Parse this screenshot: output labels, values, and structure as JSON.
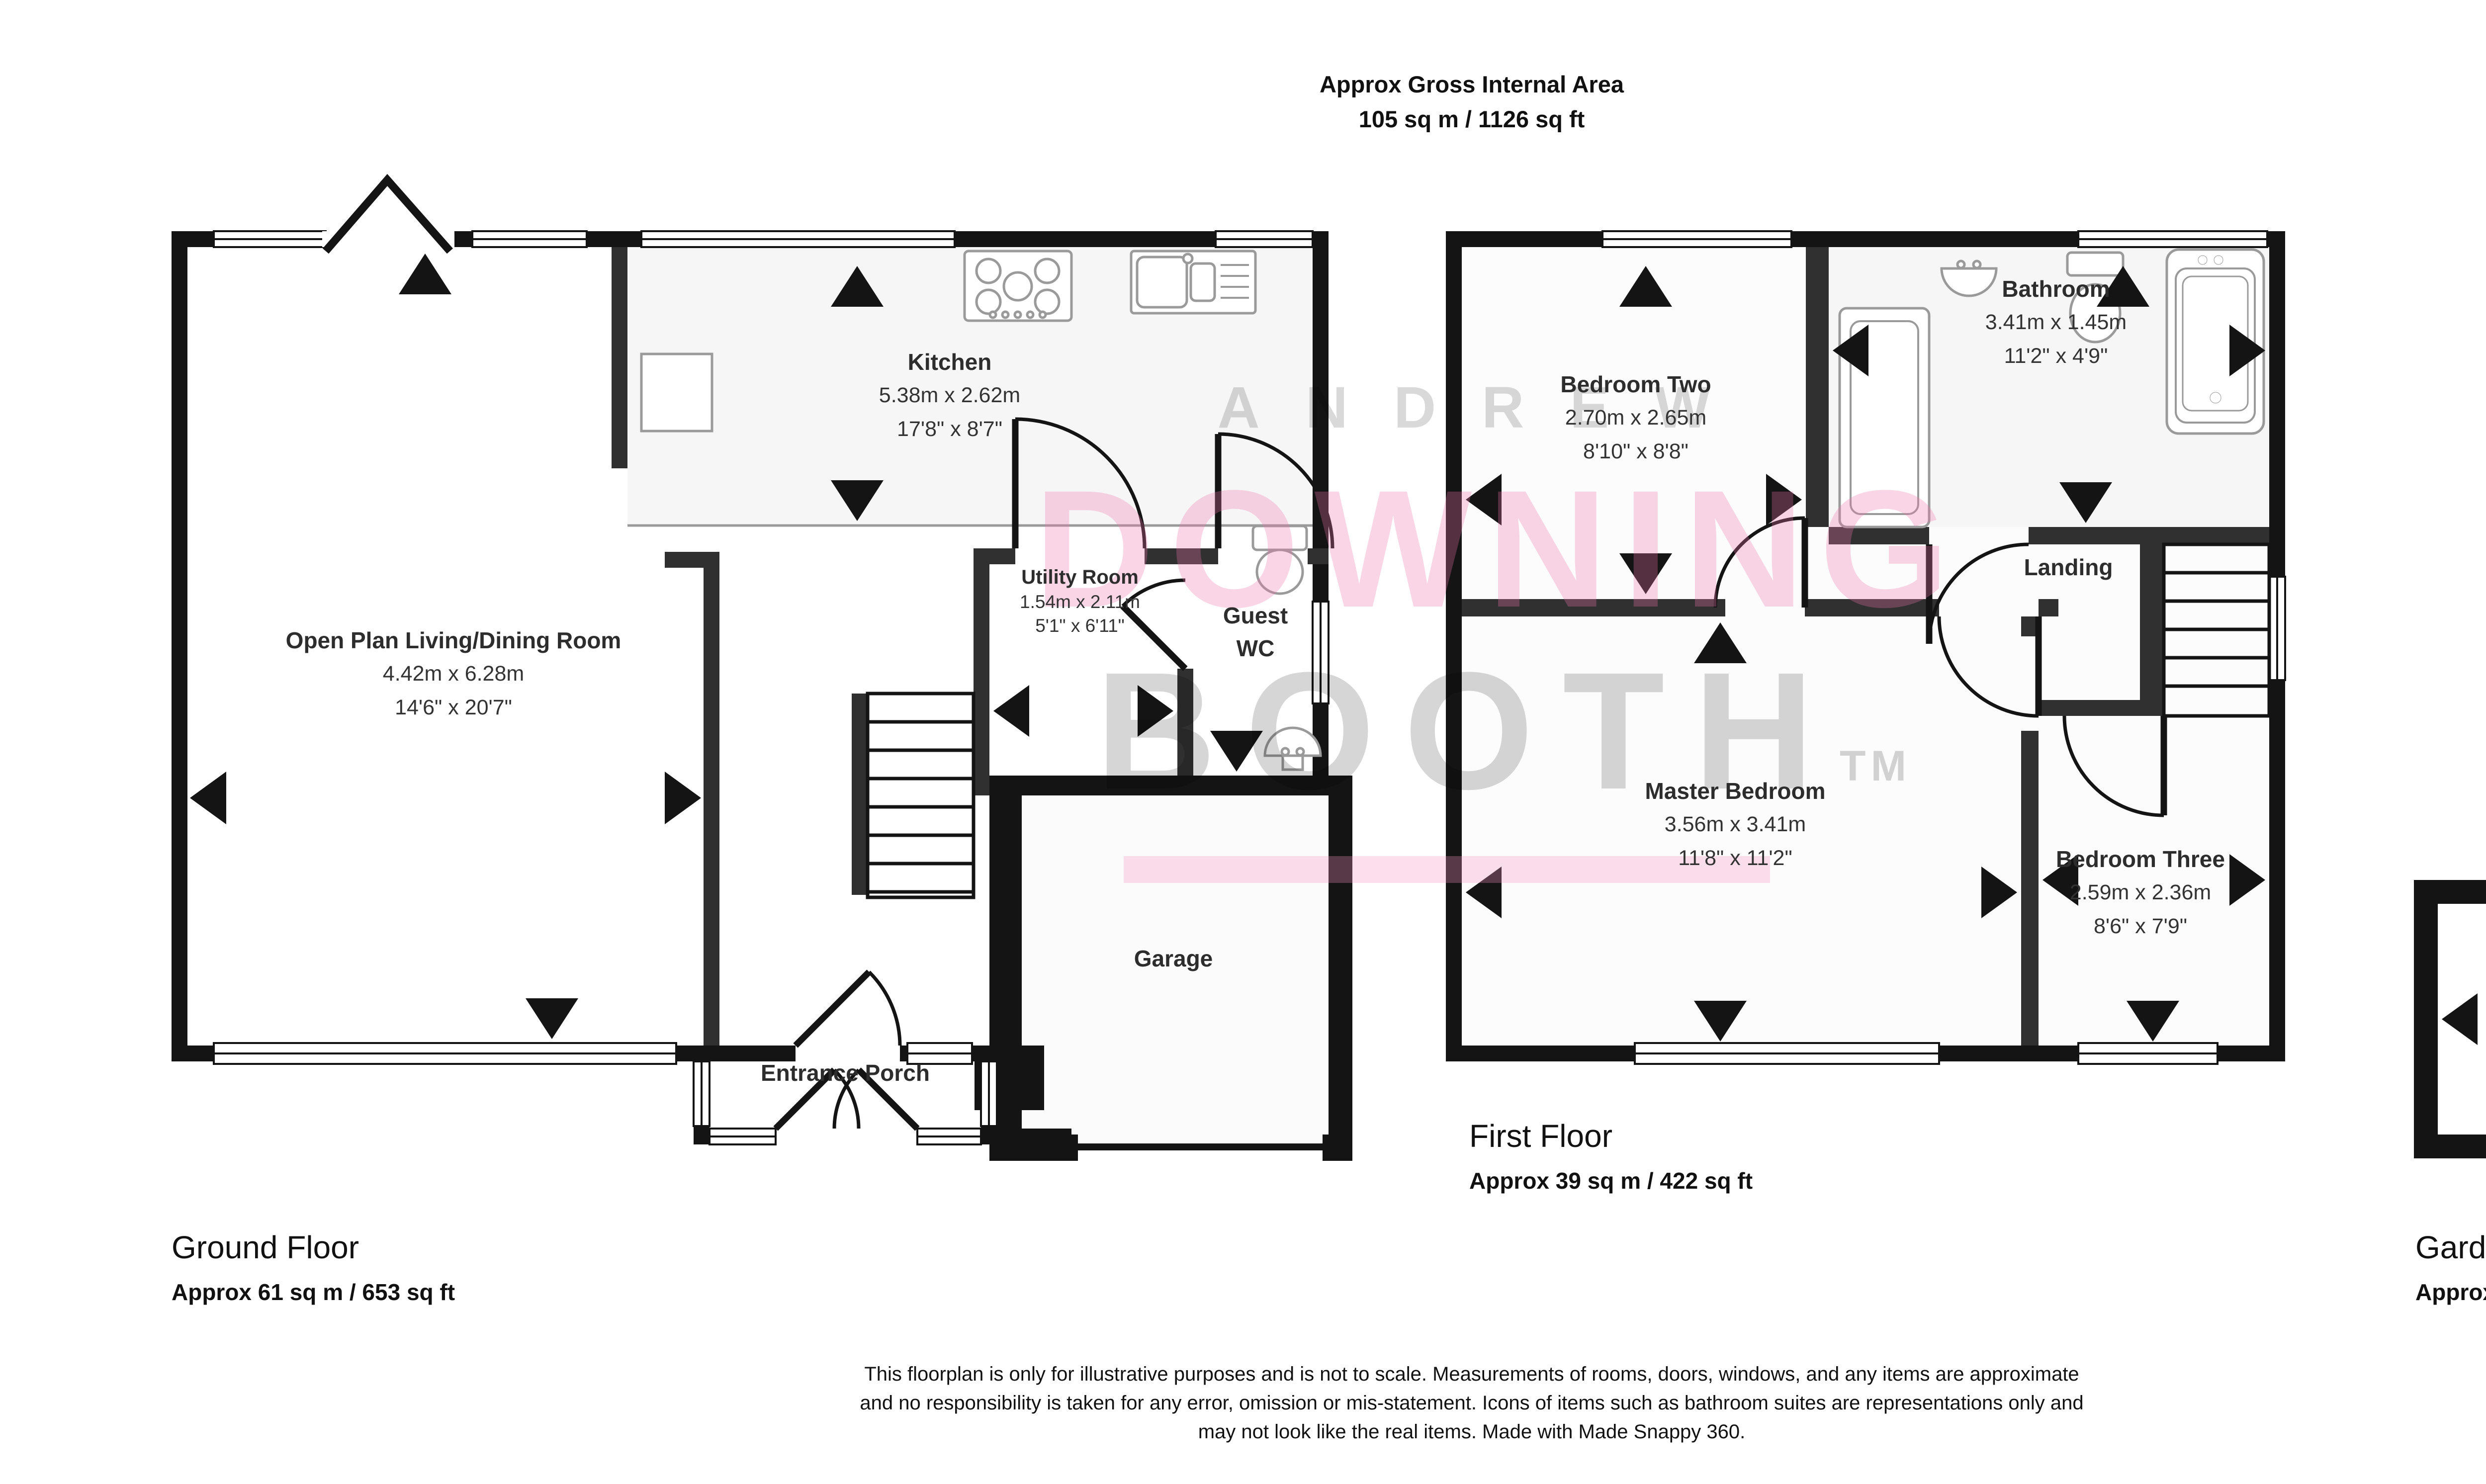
{
  "header": {
    "line1": "Approx Gross Internal Area",
    "line2": "105 sq m / 1126 sq ft"
  },
  "watermark": {
    "word1": "ANDREW",
    "word2": "DOWNING",
    "word3": "BOOTH",
    "tm": "TM",
    "gray": "#d8d8d8",
    "pink": "#f6cfe0",
    "underline_pink": "#f9d9e7"
  },
  "rooms": {
    "living": {
      "name": "Open Plan Living/Dining Room",
      "metric": "4.42m x 6.28m",
      "imperial": "14'6\" x 20'7\""
    },
    "kitchen": {
      "name": "Kitchen",
      "metric": "5.38m x 2.62m",
      "imperial": "17'8\" x 8'7\""
    },
    "utility": {
      "name": "Utility Room",
      "metric": "1.54m x 2.11m",
      "imperial": "5'1\" x 6'11\""
    },
    "guest_wc": {
      "line1": "Guest",
      "line2": "WC"
    },
    "garage": {
      "name": "Garage"
    },
    "porch": {
      "name": "Entrance Porch"
    },
    "bedroom_two": {
      "name": "Bedroom Two",
      "metric": "2.70m x 2.65m",
      "imperial": "8'10\" x 8'8\""
    },
    "bathroom": {
      "name": "Bathroom",
      "metric": "3.41m x 1.45m",
      "imperial": "11'2\" x 4'9\""
    },
    "landing": {
      "name": "Landing"
    },
    "master": {
      "name": "Master Bedroom",
      "metric": "3.56m x 3.41m",
      "imperial": "11'8\" x 11'2\""
    },
    "bedroom_three": {
      "name": "Bedroom Three",
      "metric": "2.59m x 2.36m",
      "imperial": "8'6\" x 7'9\""
    },
    "garden_room": {
      "name": "Garden Room",
      "metric": "2.50m x 1.90m",
      "imperial": "8'2\" x 6'3\""
    }
  },
  "floors": {
    "ground": {
      "title": "Ground Floor",
      "area": "Approx 61 sq m / 653 sq ft"
    },
    "first": {
      "title": "First Floor",
      "area": "Approx 39 sq m / 422 sq ft"
    },
    "garden": {
      "title": "Garden Room",
      "area": "Approx 5 sq m / 51 sq ft"
    }
  },
  "disclaimer": {
    "line1": "This floorplan is only for illustrative purposes and is not to scale. Measurements of rooms, doors, windows, and any items are approximate",
    "line2": "and no responsibility is taken for any error, omission or mis-statement. Icons of items such as bathroom suites are representations only and",
    "line3": "may not look like the real items. Made with Made Snappy 360."
  },
  "colors": {
    "wall_exterior": "#141414",
    "wall_interior": "#303030",
    "fixture_outline": "#9a9a9a",
    "kitchen_floor_tint": "#f6f6f7"
  }
}
